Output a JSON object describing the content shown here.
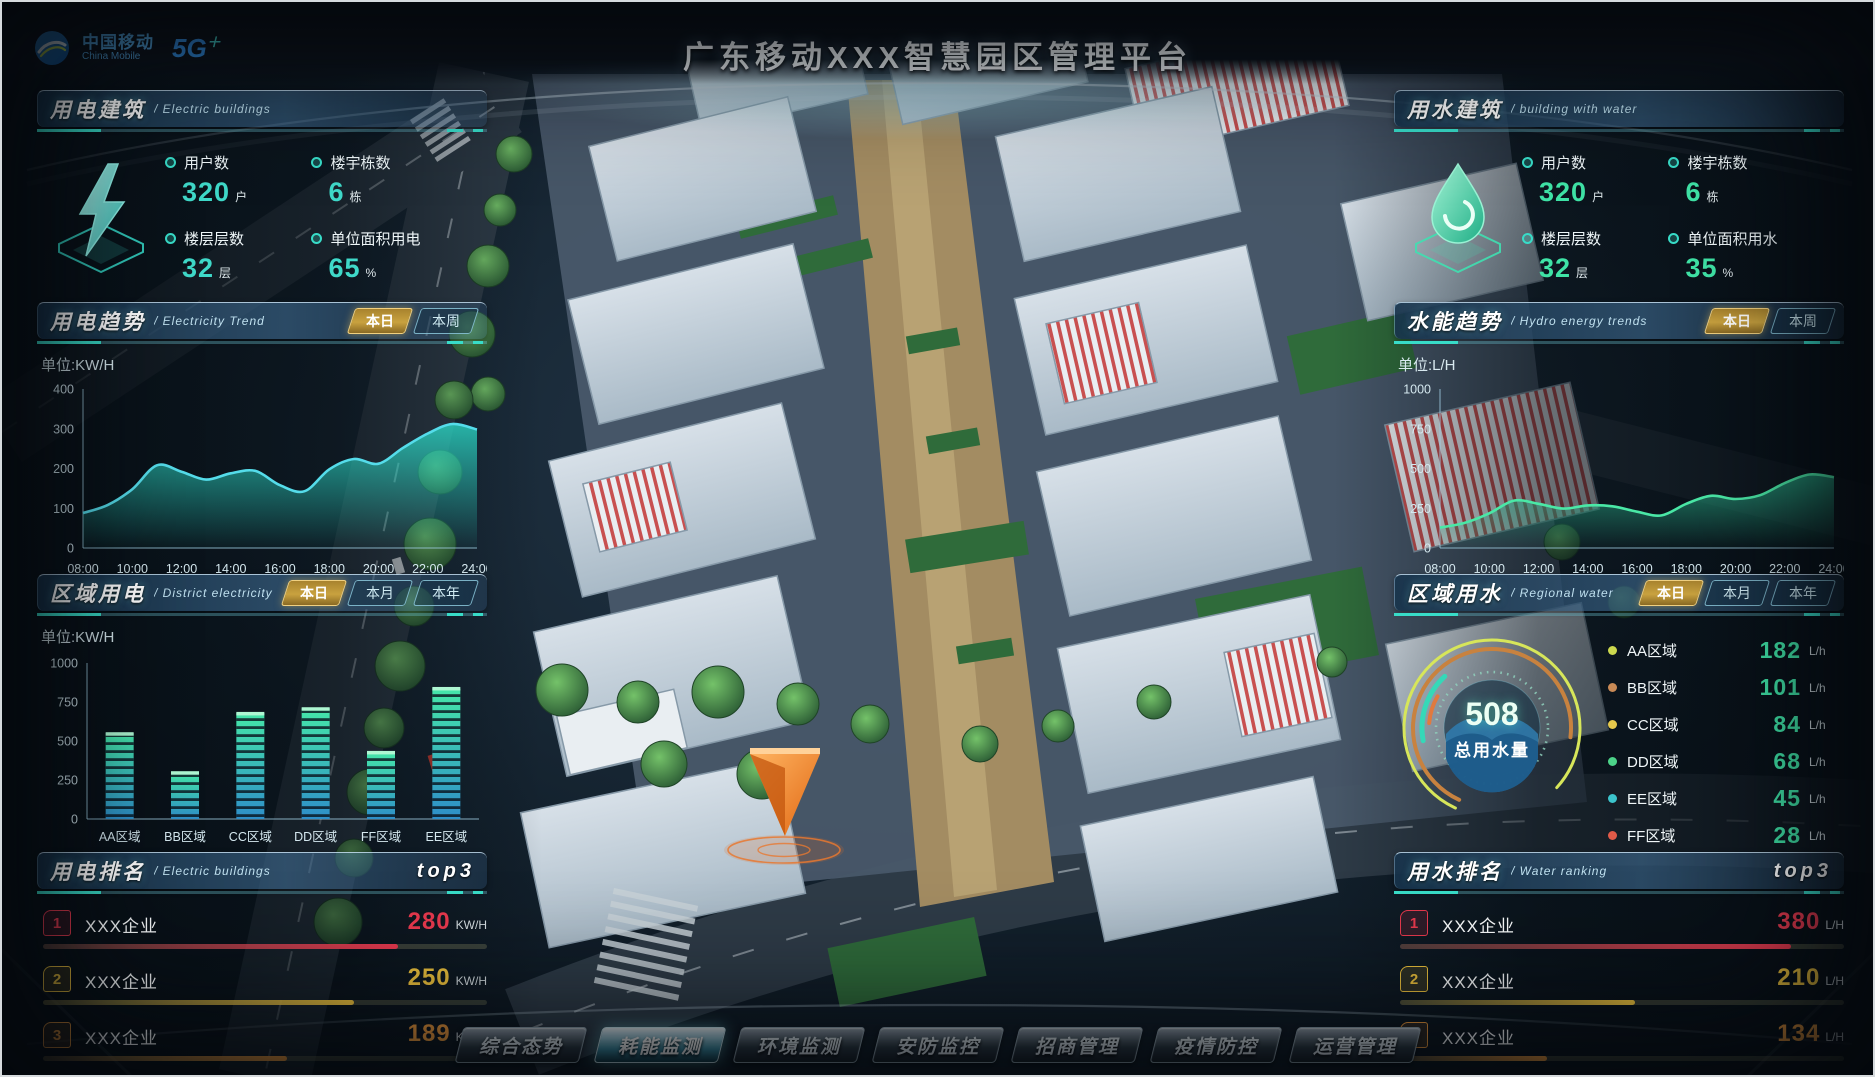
{
  "colors": {
    "accent": "#38dcc8",
    "electric_value": "#3fd9c9",
    "water_value": "#3fe3a6",
    "tab_active_gold": "#d9b34a"
  },
  "header": {
    "brand_cn": "中国移动",
    "brand_en": "China Mobile",
    "badge_5g": "5G",
    "title": "广东移动XXX智慧园区管理平台"
  },
  "panels": {
    "electric_building": {
      "title": "用电建筑",
      "subtitle": "/ Electric buildings",
      "stats": [
        {
          "label": "用户数",
          "value": "320",
          "unit": "户"
        },
        {
          "label": "楼宇栋数",
          "value": "6",
          "unit": "栋"
        },
        {
          "label": "楼层层数",
          "value": "32",
          "unit": "层"
        },
        {
          "label": "单位面积用电",
          "value": "65",
          "unit": "%"
        }
      ]
    },
    "electricity_trend": {
      "title": "用电趋势",
      "subtitle": "/ Electricity Trend",
      "unit_label": "单位:KW/H",
      "tabs": [
        {
          "label": "本日",
          "active": true
        },
        {
          "label": "本周",
          "active": false
        }
      ]
    },
    "district_electricity": {
      "title": "区域用电",
      "subtitle": "/ District electricity",
      "unit_label": "单位:KW/H",
      "tabs": [
        {
          "label": "本日",
          "active": true
        },
        {
          "label": "本月",
          "active": false
        },
        {
          "label": "本年",
          "active": false
        }
      ]
    },
    "electric_ranking": {
      "title": "用电排名",
      "subtitle": "/ Electric buildings",
      "badge": "top3",
      "rows": [
        {
          "rank": "1",
          "name": "XXX企业",
          "value": "280",
          "unit": "KW/H",
          "color": "#e8394e",
          "pct": 80
        },
        {
          "rank": "2",
          "name": "XXX企业",
          "value": "250",
          "unit": "KW/H",
          "color": "#f2c53d",
          "pct": 70
        },
        {
          "rank": "3",
          "name": "XXX企业",
          "value": "189",
          "unit": "KW/H",
          "color": "#f29d3d",
          "pct": 55
        }
      ]
    },
    "water_building": {
      "title": "用水建筑",
      "subtitle": "/ building with water",
      "stats": [
        {
          "label": "用户数",
          "value": "320",
          "unit": "户"
        },
        {
          "label": "楼宇栋数",
          "value": "6",
          "unit": "栋"
        },
        {
          "label": "楼层层数",
          "value": "32",
          "unit": "层"
        },
        {
          "label": "单位面积用水",
          "value": "35",
          "unit": "%"
        }
      ]
    },
    "hydro_trend": {
      "title": "水能趋势",
      "subtitle": "/ Hydro energy trends",
      "unit_label": "单位:L/H",
      "tabs": [
        {
          "label": "本日",
          "active": true
        },
        {
          "label": "本周",
          "active": false
        }
      ]
    },
    "regional_water": {
      "title": "区域用水",
      "subtitle": "/ Regional water",
      "tabs": [
        {
          "label": "本日",
          "active": true
        },
        {
          "label": "本月",
          "active": false
        },
        {
          "label": "本年",
          "active": false
        }
      ],
      "gauge": {
        "value": "508",
        "label": "总用水量"
      },
      "legend": [
        {
          "name": "AA区域",
          "value": "182",
          "unit": "L/h",
          "color": "#ccd84e"
        },
        {
          "name": "BB区域",
          "value": "101",
          "unit": "L/h",
          "color": "#c98a56"
        },
        {
          "name": "CC区域",
          "value": "84",
          "unit": "L/h",
          "color": "#e6c84c"
        },
        {
          "name": "DD区域",
          "value": "68",
          "unit": "L/h",
          "color": "#4cd389"
        },
        {
          "name": "EE区域",
          "value": "45",
          "unit": "L/h",
          "color": "#3cc4cc"
        },
        {
          "name": "FF区域",
          "value": "28",
          "unit": "L/h",
          "color": "#e05a48"
        }
      ]
    },
    "water_ranking": {
      "title": "用水排名",
      "subtitle": "/ Water ranking",
      "badge": "top3",
      "rows": [
        {
          "rank": "1",
          "name": "XXX企业",
          "value": "380",
          "unit": "L/H",
          "color": "#e8394e",
          "pct": 88
        },
        {
          "rank": "2",
          "name": "XXX企业",
          "value": "210",
          "unit": "L/H",
          "color": "#f2c53d",
          "pct": 53
        },
        {
          "rank": "3",
          "name": "XXX企业",
          "value": "134",
          "unit": "L/H",
          "color": "#f29d3d",
          "pct": 33
        }
      ]
    }
  },
  "bottom_nav": {
    "items": [
      {
        "label": "综合态势",
        "active": false
      },
      {
        "label": "耗能监测",
        "active": true
      },
      {
        "label": "环境监测",
        "active": false
      },
      {
        "label": "安防监控",
        "active": false
      },
      {
        "label": "招商管理",
        "active": false
      },
      {
        "label": "疫情防控",
        "active": false
      },
      {
        "label": "运营管理",
        "active": false
      }
    ]
  },
  "chart_data": [
    {
      "id": "elec",
      "type": "line",
      "title": "用电趋势 Electricity Trend",
      "ylabel": "KW/H",
      "ylim": [
        0,
        400
      ],
      "yticks": [
        0,
        100,
        200,
        300,
        400
      ],
      "xticks": [
        "08:00",
        "10:00",
        "12:00",
        "14:00",
        "16:00",
        "18:00",
        "20:00",
        "22:00",
        "24:00"
      ],
      "values": [
        88,
        108,
        148,
        208,
        192,
        172,
        188,
        194,
        158,
        143,
        198,
        224,
        212,
        252,
        288,
        312,
        298
      ],
      "line_color": "#55dcea",
      "fill_color": "#2bd6c4",
      "grid": false,
      "legend_position": "none"
    },
    {
      "id": "hydro",
      "type": "line",
      "title": "水能趋势 Hydro energy trends",
      "ylabel": "L/H",
      "ylim": [
        0,
        1000
      ],
      "yticks": [
        0,
        250,
        500,
        750,
        1000
      ],
      "xticks": [
        "08:00",
        "10:00",
        "12:00",
        "14:00",
        "16:00",
        "18:00",
        "20:00",
        "22:00",
        "24:00"
      ],
      "values": [
        128,
        158,
        218,
        298,
        278,
        248,
        268,
        262,
        228,
        205,
        278,
        328,
        308,
        332,
        408,
        462,
        445
      ],
      "line_color": "#4ae8a6",
      "fill_color": "#26a07e",
      "grid": false,
      "legend_position": "none"
    },
    {
      "id": "district",
      "type": "bar",
      "title": "区域用电 District electricity",
      "ylabel": "KW/H",
      "categories": [
        "AA区域",
        "BB区域",
        "CC区域",
        "DD区域",
        "FF区域",
        "EE区域"
      ],
      "values": [
        550,
        300,
        680,
        710,
        430,
        840
      ],
      "ylim": [
        0,
        1000
      ],
      "yticks": [
        0,
        250,
        500,
        750,
        1000
      ],
      "bar_gradient": [
        "#2e8ec8",
        "#45e6a8"
      ],
      "grid": false,
      "legend_position": "none"
    },
    {
      "id": "waterdonut",
      "type": "pie",
      "title": "区域用水 Regional water",
      "center_value": "508",
      "center_label": "总用水量",
      "segments": [
        {
          "name": "AA区域",
          "value": 182,
          "color": "#ccd84e"
        },
        {
          "name": "BB区域",
          "value": 101,
          "color": "#c98a56"
        },
        {
          "name": "CC区域",
          "value": 84,
          "color": "#e6c84c"
        },
        {
          "name": "DD区域",
          "value": 68,
          "color": "#4cd389"
        },
        {
          "name": "EE区域",
          "value": 45,
          "color": "#3cc4cc"
        },
        {
          "name": "FF区域",
          "value": 28,
          "color": "#e05a48"
        }
      ]
    }
  ]
}
